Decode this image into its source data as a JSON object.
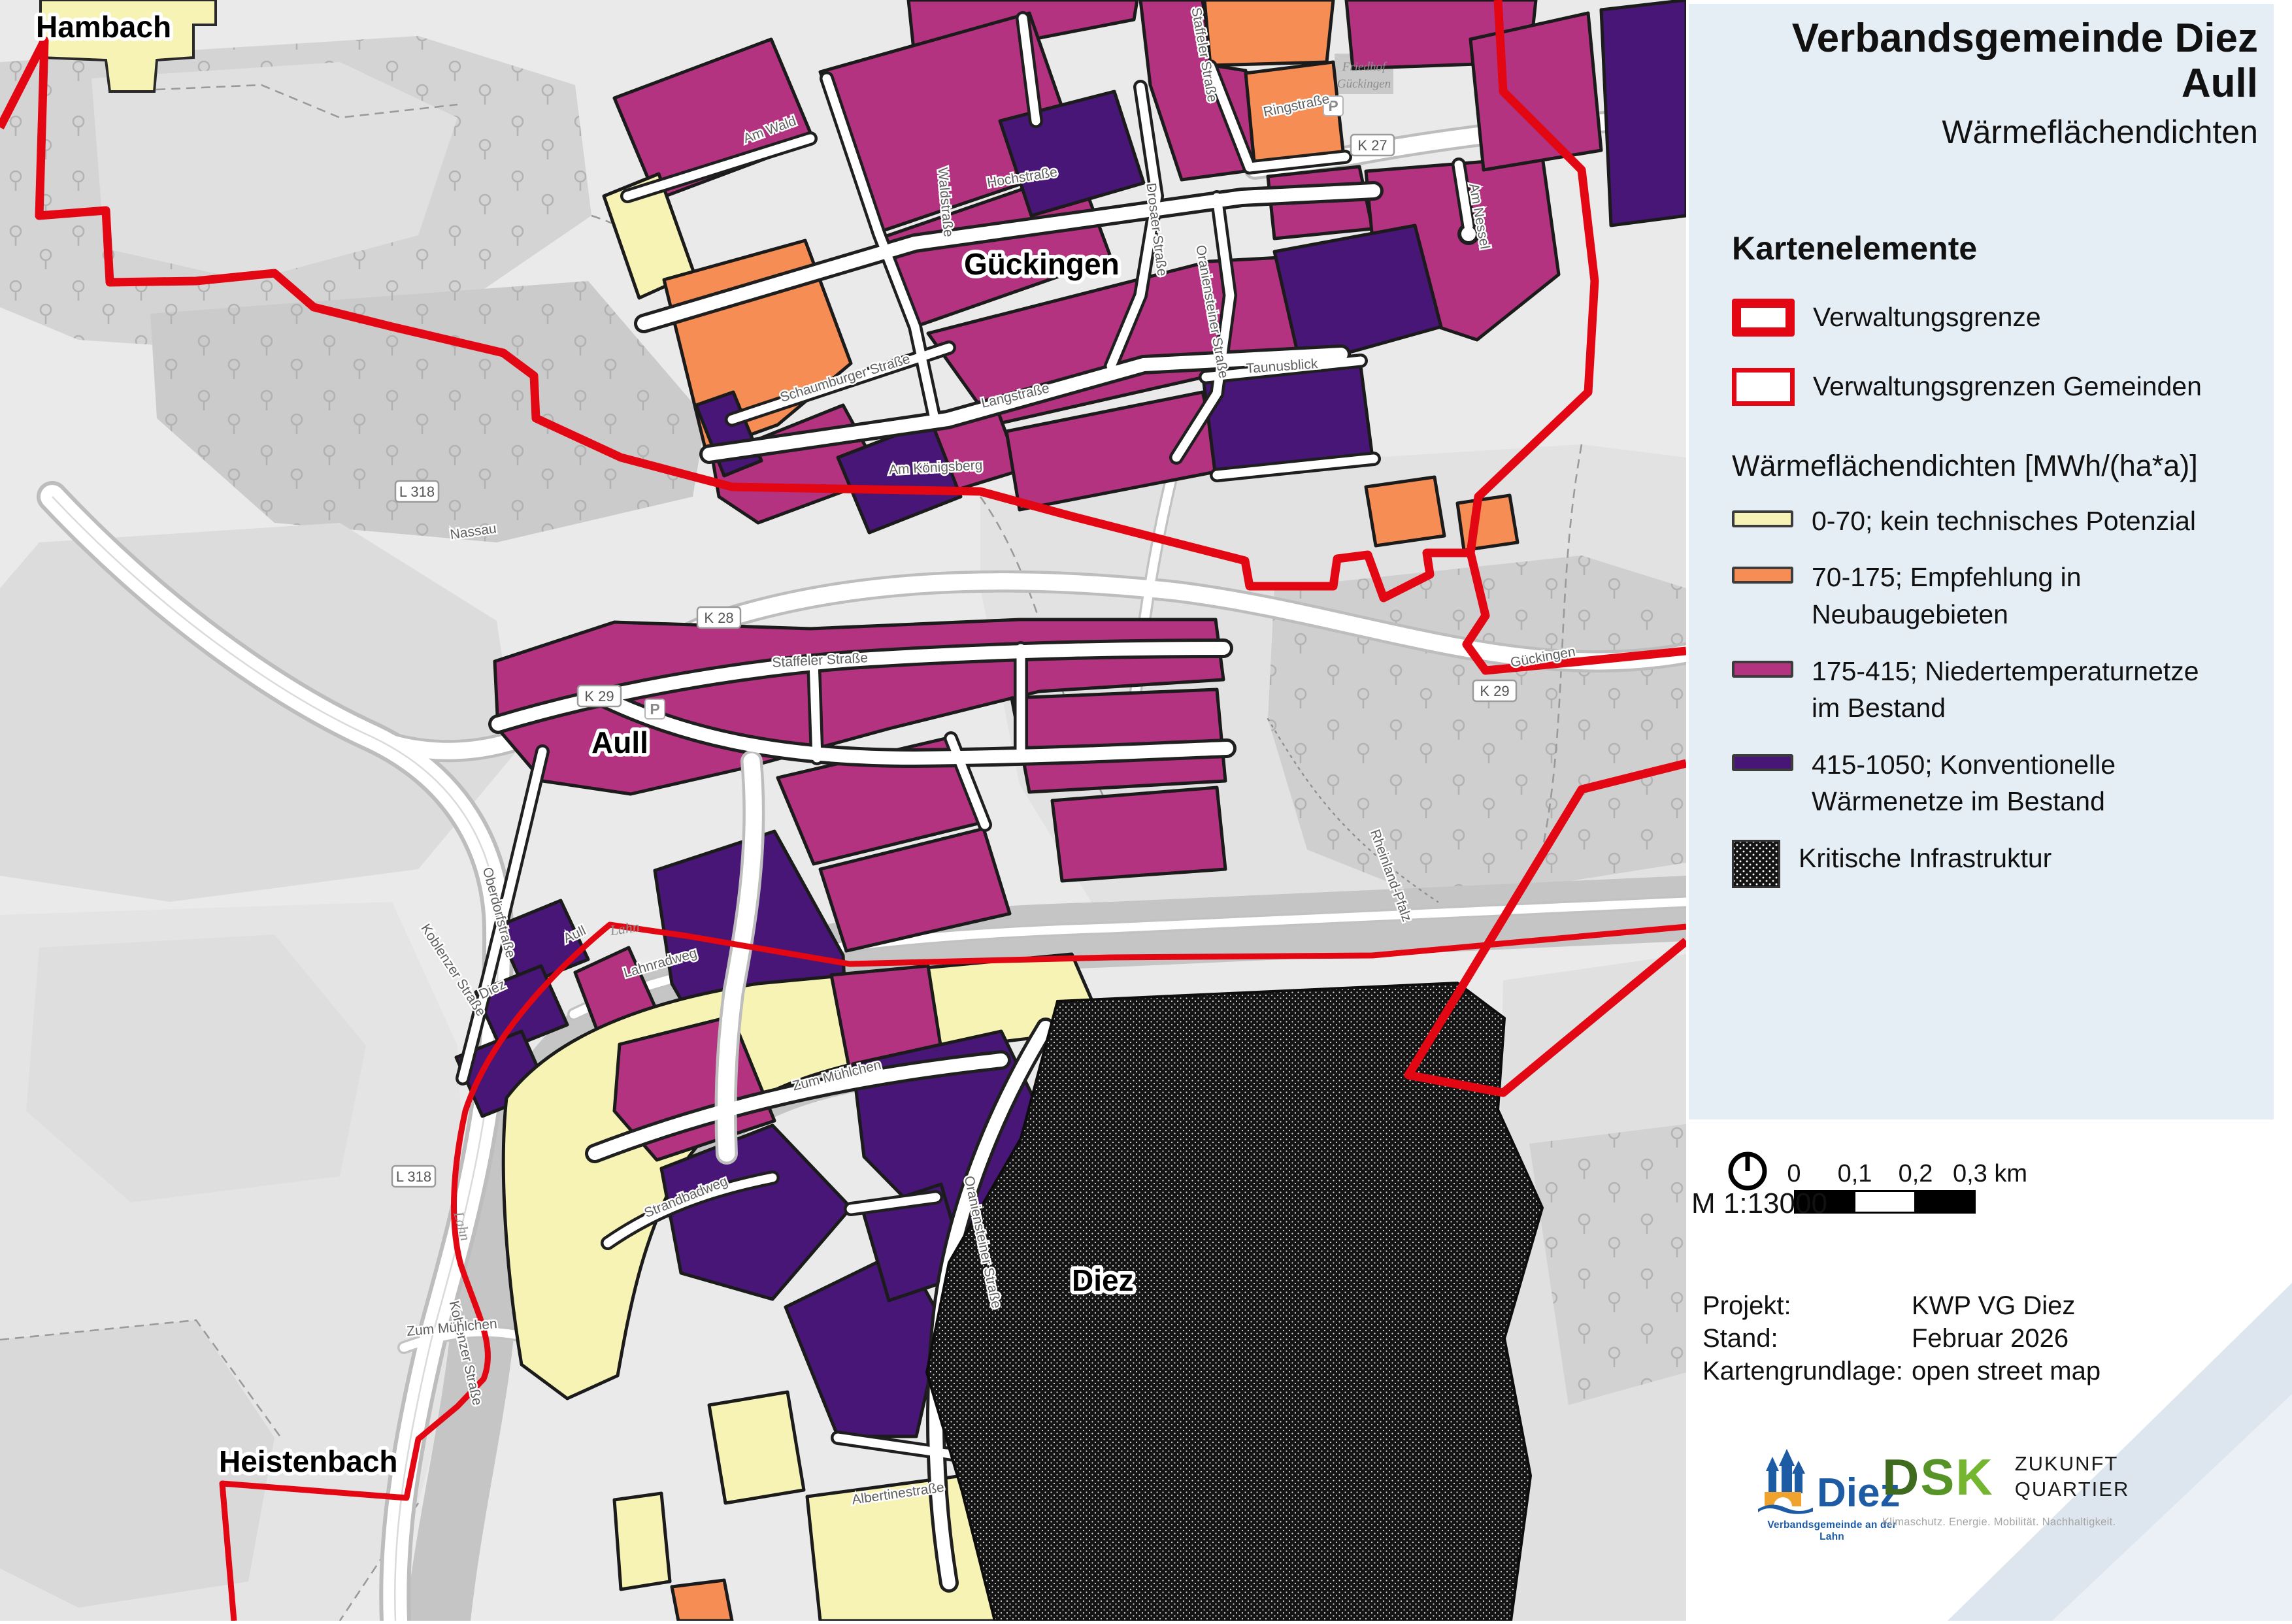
{
  "title": {
    "line1": "Verbandsgemeinde Diez",
    "line2": "Aull",
    "subtitle": "Wärmeflächendichten"
  },
  "legend": {
    "heading": "Kartenelemente",
    "admin_items": [
      {
        "label": "Verwaltungsgrenze"
      },
      {
        "label": "Verwaltungsgrenzen Gemeinden"
      }
    ],
    "heat_heading": "Wärmeflächendichten [MWh/(ha*a)]",
    "heat_items": [
      {
        "range": "0-70; kein technisches Potenzial",
        "color": "#f6f3b5"
      },
      {
        "range": "70-175; Empfehlung in Neubaugebieten",
        "color": "#f58d54"
      },
      {
        "range": "175-415; Niedertemperaturnetze im Bestand",
        "color": "#b43380"
      },
      {
        "range": "415-1050; Konventionelle Wärmenetze im Bestand",
        "color": "#471677"
      },
      {
        "range": "Kritische Infrastruktur",
        "color": "#141414"
      }
    ]
  },
  "scalebar": {
    "scale": "M 1:13000",
    "ticks": [
      "0",
      "0,1",
      "0,2",
      "0,3 km"
    ]
  },
  "project": {
    "rows": [
      [
        "Projekt:",
        "KWP VG Diez"
      ],
      [
        "Stand:",
        "Februar 2026"
      ],
      [
        "Kartengrundlage:",
        "open street map"
      ]
    ]
  },
  "logos": {
    "diez": {
      "name": "Diez",
      "subtitle": "Verbandsgemeinde an der Lahn"
    },
    "dsk": {
      "name_d": "D",
      "name_s": "S",
      "name_k": "K",
      "right1": "ZUKUNFT",
      "right2": "QUARTIER",
      "tagline": "Klimaschutz. Energie. Mobilität. Nachhaltigkeit."
    }
  },
  "map": {
    "place_labels": [
      "Hambach",
      "Gückingen",
      "Aull",
      "Diez",
      "Heistenbach"
    ],
    "route_shields": [
      "L 318",
      "L 318",
      "K 28",
      "K 29",
      "K 29",
      "K 27"
    ],
    "street_labels": [
      "Am Wald",
      "Hochstraße",
      "Waldstraße",
      "Schaumburger Straße",
      "Drosaer Straße",
      "Langstraße",
      "Oraniensteiner Straße",
      "Ringstraße",
      "Staffeler Straße",
      "Staffeler Straße",
      "Koblenzer Straße",
      "Koblenzer Straße",
      "Lahnradweg",
      "Zum Mühlchen",
      "Zum Mühlchen",
      "Oraniensteiner Straße",
      "Strandbadweg",
      "Taunusblick",
      "Am Nessel",
      "Oberdorfstraße",
      "Albertinestraße",
      "Am Königsberg"
    ],
    "minor_labels": [
      "Lahn",
      "Lahn",
      "Aull",
      "Diez",
      "Nassau",
      "Rheinland-Pfalz",
      "Gückingen",
      "Friedhof",
      "Gückingen"
    ],
    "poi": [
      "P",
      "P"
    ]
  },
  "colors": {
    "accent_red": "#e30613",
    "panel_bg": "#e6eef5",
    "heat_yellow": "#f6f3b5",
    "heat_orange": "#f58d54",
    "heat_magenta": "#b43380",
    "heat_purple": "#471677",
    "critical_black": "#141414"
  }
}
